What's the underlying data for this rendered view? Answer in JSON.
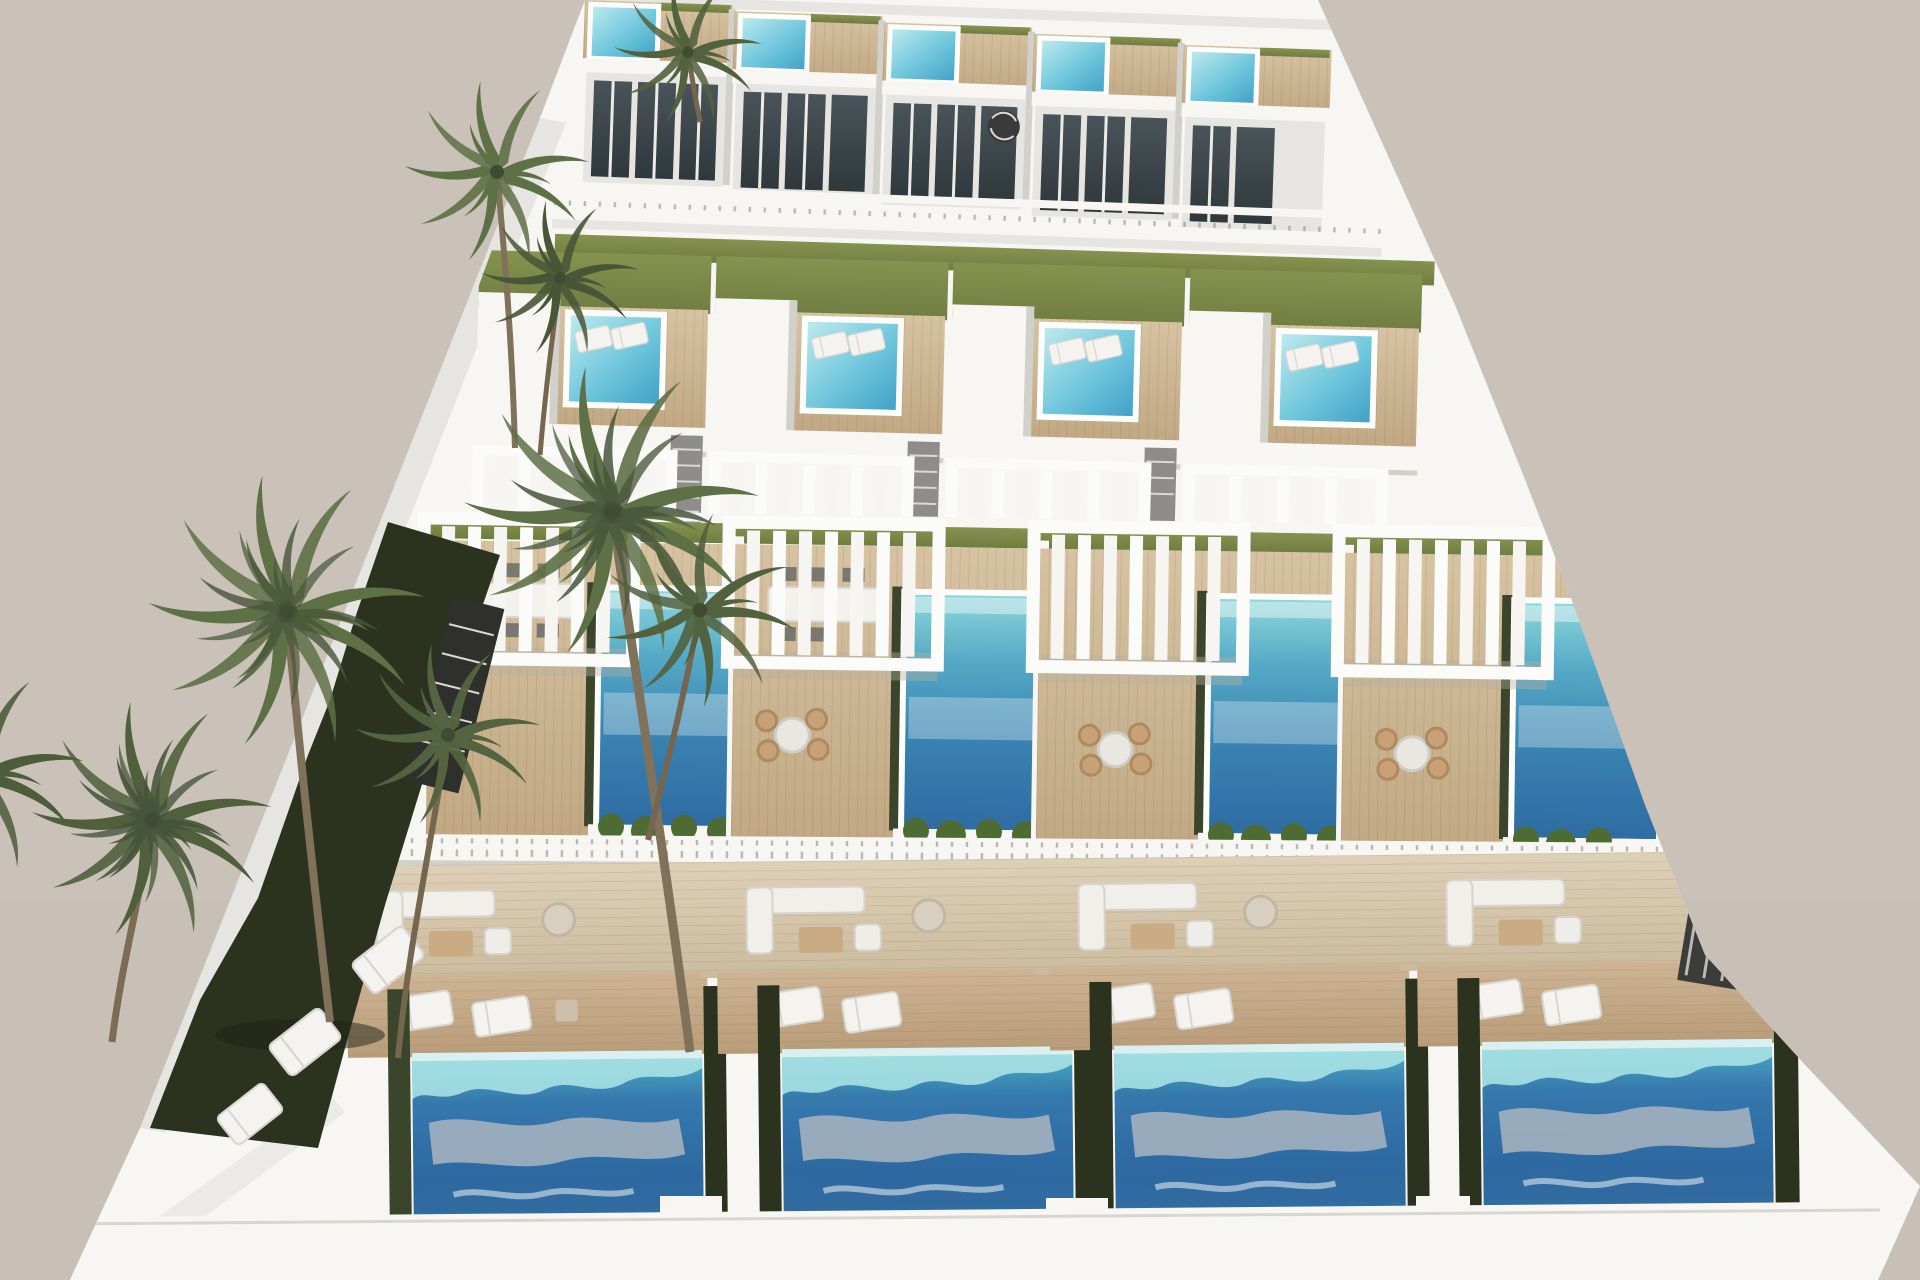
{
  "meta": {
    "type": "architectural-3d-render",
    "subject": "Aerial daylight rendering of a stepped complex of modern white villas, each with roof terraces, pergolas and private swimming pools, surrounded by palm trees",
    "view": "high aerial three-quarter view, warm grey backdrop"
  },
  "counts": {
    "top_row_villas": 5,
    "second_row_villas": 4,
    "main_roof_terraces": 4,
    "ground_level_pools": 4,
    "roof_pools": 9,
    "pergolas": 8,
    "palm_trees": 7,
    "sun_lounger_pads_on_lawn": 3
  },
  "palette": {
    "background": "#cac2b8",
    "wall_white": "#f7f6f3",
    "wall_shadow": "#e6e5e1",
    "wall_dark": "#d2d0cb",
    "deck_wood_light": "#d6c3a2",
    "deck_wood": "#c1a883",
    "deck_ground_light": "#cdb494",
    "deck_ground": "#b99c79",
    "tile_light": "#ddd0b8",
    "tile": "#cbbb9e",
    "lawn_olive_light": "#86924f",
    "lawn_olive": "#6f7d41",
    "lawn_dark": "#2b331e",
    "hedge_green": "#3a452b",
    "plant_green": "#4e6b33",
    "palm_green": "#5e7046",
    "palm_green_dark": "#475637",
    "trunk_brown": "#80715a",
    "glass_light": "#49545a",
    "glass_dark": "#2f383b",
    "pool_roof_light": "#c2ecef",
    "pool_roof_mid": "#6fc6dc",
    "pool_roof_deep": "#3e9ec6",
    "pool_mid_teal": "#8fd9dc",
    "pool_mid_blue": "#3a83b2",
    "pool_mid_deep": "#2e6ba1",
    "pool_ground_teal": "#4fb3c8",
    "pool_ground_blue": "#3579ad",
    "pool_ground_deep": "#2d68a0",
    "pool_fringe": "#aee6e6",
    "pool_reflection": "#a9b5c1",
    "grille_dark": "#3c3c3a"
  }
}
